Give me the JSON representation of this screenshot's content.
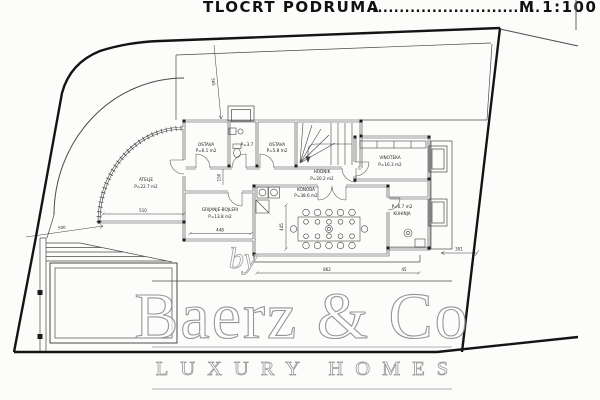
{
  "sheet": {
    "title": "TLOCRT PODRUMA",
    "title_dots": "...............................",
    "title_scale": "M 1:100"
  },
  "rooms": {
    "atelje": {
      "name": "ATELJE",
      "area": "P=22.7 m2"
    },
    "ostava1": {
      "name": "OSTAVA",
      "area": "P=6.1 m2"
    },
    "wc": {
      "area": "P=3.7"
    },
    "ostava2": {
      "name": "OSTAVA",
      "area": "P=5.8 m2"
    },
    "vinoteka": {
      "name": "VINOTEKA",
      "area": "P=16.3 m2"
    },
    "hodnik": {
      "name": "HODNIK",
      "area": "P=20.2 m2"
    },
    "konoba": {
      "name": "KONOBA",
      "area": "P=38.6 m2"
    },
    "grijanje": {
      "name": "GRIJANJE-BOJLERI",
      "area": "P=13.8 m2"
    },
    "kuhinja": {
      "name": "KUHINJA",
      "area": "P=6.7 m2"
    }
  },
  "dimensions": {
    "atelje_width": "510",
    "grijanje_width": "448",
    "konoba_width": "862",
    "konoba_offset": "45",
    "konoba_height": "445",
    "pool_dim": "500",
    "right_dim": "301",
    "corridor_width": "150",
    "entry_dim": "565"
  },
  "watermark": {
    "by": "by",
    "brand": "Baerz & Co",
    "tagline": "LUXURY HOMES"
  },
  "colors": {
    "background": "#fcfcfb",
    "wall_line": "#3f3f3f",
    "boundary_line": "#141414",
    "watermark_gray": "#9a9a9a"
  }
}
